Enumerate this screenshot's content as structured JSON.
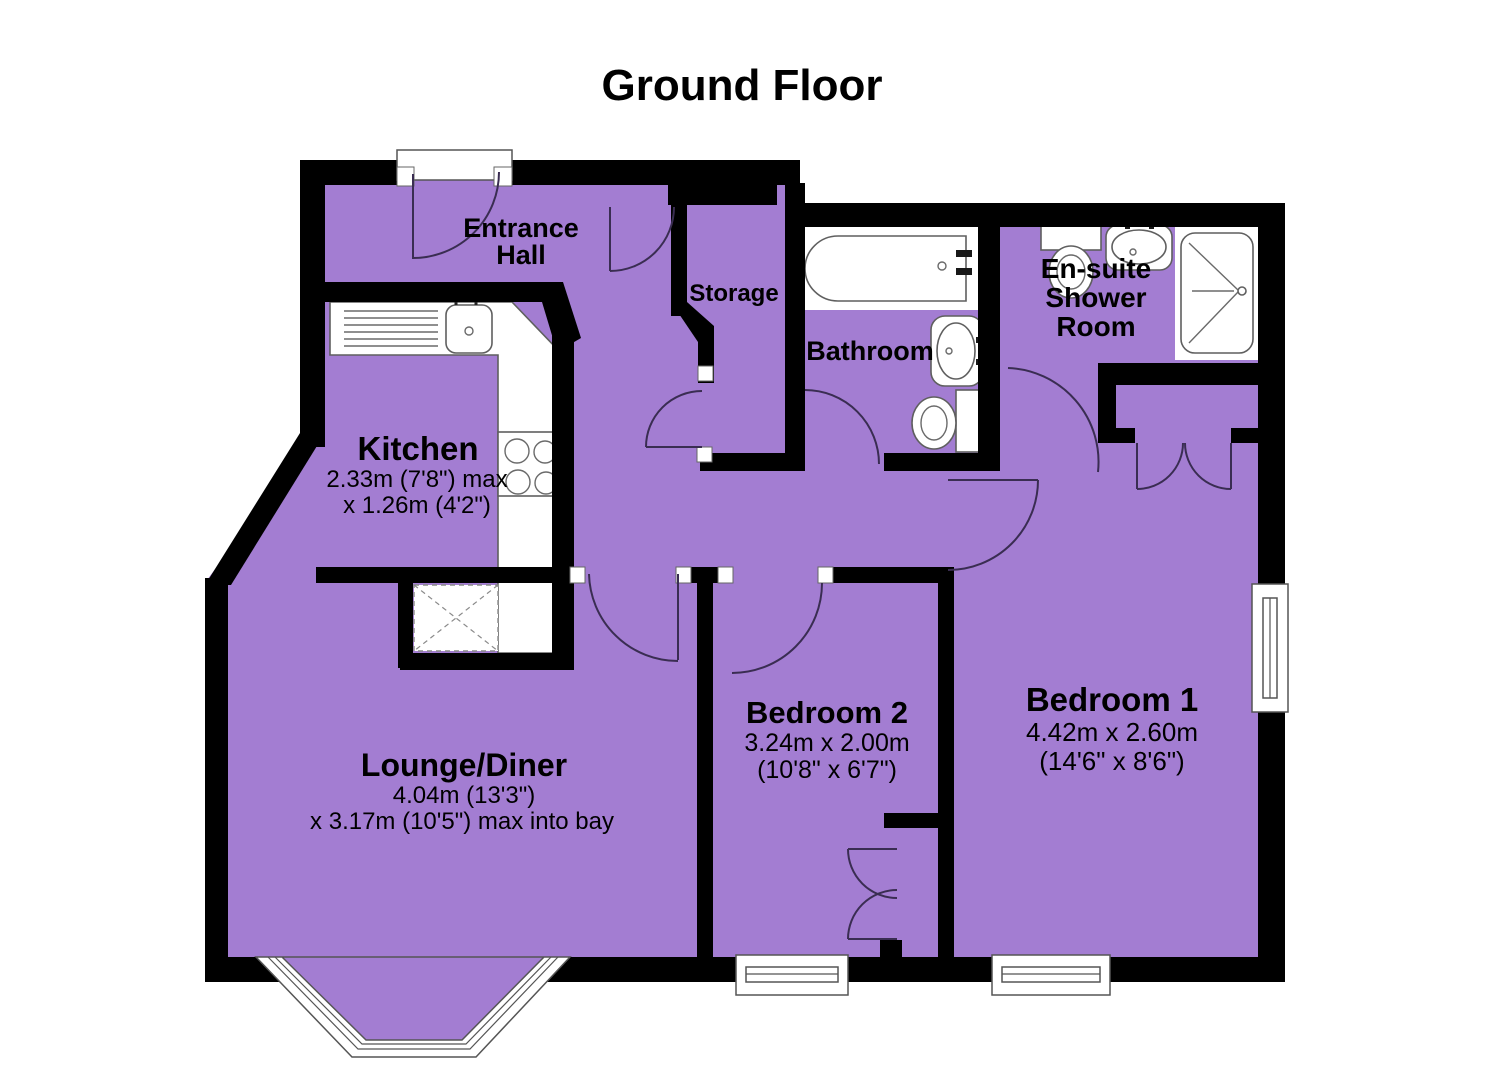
{
  "title": "Ground Floor",
  "colors": {
    "room_fill": "#a37dd2",
    "wall": "#000000",
    "fixture_stroke": "#5f5f5f",
    "door_arc": "#3a2d52",
    "background": "#ffffff"
  },
  "rooms": {
    "entrance_hall": {
      "line1": "Entrance",
      "line2": "Hall"
    },
    "storage": {
      "label": "Storage"
    },
    "bathroom": {
      "label": "Bathroom"
    },
    "ensuite": {
      "line1": "En-suite",
      "line2": "Shower",
      "line3": "Room"
    },
    "kitchen": {
      "label": "Kitchen",
      "dim1": "2.33m (7'8\") max",
      "dim2": "x 1.26m (4'2\")"
    },
    "lounge": {
      "label": "Lounge/Diner",
      "dim1": "4.04m (13'3\")",
      "dim2": "x 3.17m (10'5\") max into bay"
    },
    "bedroom2": {
      "label": "Bedroom 2",
      "dim1": "3.24m x 2.00m",
      "dim2": "(10'8\" x 6'7\")"
    },
    "bedroom1": {
      "label": "Bedroom 1",
      "dim1": "4.42m x 2.60m",
      "dim2": "(14'6\" x 8'6\")"
    }
  },
  "fixtures": {
    "bath": "bath",
    "bathroom_sink": "wash basin",
    "bathroom_toilet": "toilet",
    "ensuite_toilet": "toilet",
    "ensuite_sink": "wash basin",
    "shower": "shower tray",
    "kitchen_sink": "sink and drainer",
    "hob": "hob",
    "appliance": "appliance space",
    "bay_window": "bay window",
    "windows": "windows",
    "doors": "door swings"
  }
}
